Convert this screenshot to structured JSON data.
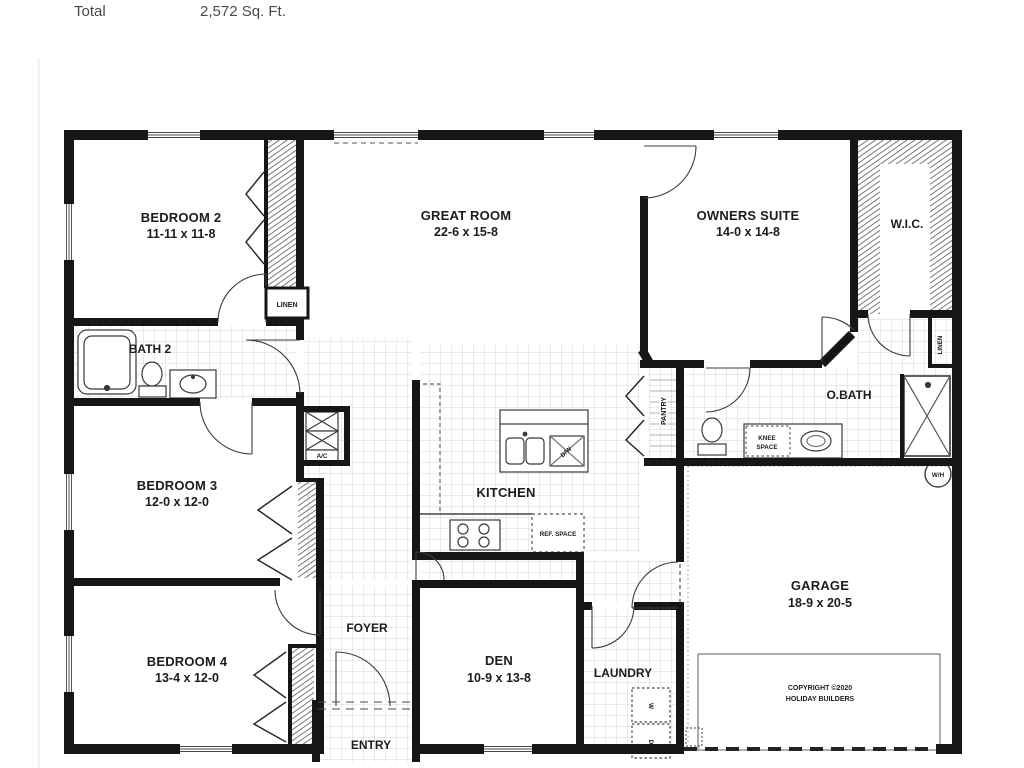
{
  "header": {
    "total_label": "Total",
    "total_value": "2,572 Sq. Ft."
  },
  "rooms": {
    "bedroom2": {
      "name": "BEDROOM 2",
      "dims": "11-11 x 11-8"
    },
    "great_room": {
      "name": "GREAT ROOM",
      "dims": "22-6 x 15-8"
    },
    "owners_suite": {
      "name": "OWNERS SUITE",
      "dims": "14-0 x 14-8"
    },
    "wic": {
      "name": "W.I.C."
    },
    "bath2": {
      "name": "BATH 2"
    },
    "bedroom3": {
      "name": "BEDROOM 3",
      "dims": "12-0 x 12-0"
    },
    "obath": {
      "name": "O.BATH"
    },
    "kitchen": {
      "name": "KITCHEN"
    },
    "garage": {
      "name": "GARAGE",
      "dims": "18-9 x 20-5"
    },
    "foyer": {
      "name": "FOYER"
    },
    "bedroom4": {
      "name": "BEDROOM 4",
      "dims": "13-4 x 12-0"
    },
    "den": {
      "name": "DEN",
      "dims": "10-9 x 13-8"
    },
    "laundry": {
      "name": "LAUNDRY"
    },
    "entry": {
      "name": "ENTRY"
    }
  },
  "labels": {
    "linen": "LINEN",
    "linen2": "LINEN",
    "pantry": "PANTRY",
    "ac": "A/C",
    "dw": "D/W",
    "ref_space": "REF. SPACE",
    "knee1": "KNEE",
    "knee2": "SPACE",
    "wh": "W/H",
    "washer": "W",
    "dryer": "D",
    "copyright1": "COPYRIGHT ©2020",
    "copyright2": "HOLIDAY BUILDERS"
  },
  "colors": {
    "wall": "#161616",
    "tile_line": "#d4d4d4",
    "hatch": "#555555"
  }
}
